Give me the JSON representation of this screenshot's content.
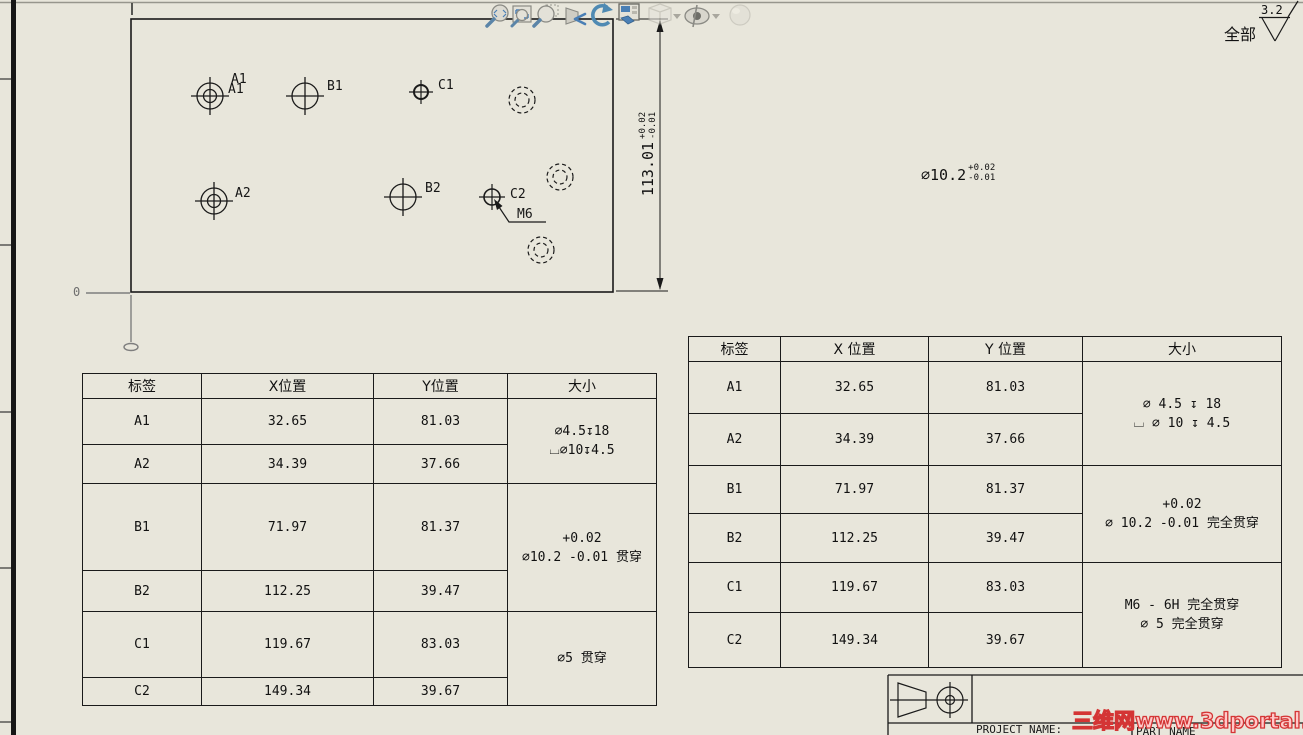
{
  "toolbar": {
    "icons": [
      "zoom-to-fit-icon",
      "zoom-to-area-icon",
      "zoom-icon",
      "previous-view-icon",
      "rotate-view-icon",
      "view-orientation-icon",
      "display-style-icon",
      "hide-show-items-icon",
      "edit-appearance-icon"
    ]
  },
  "drawing": {
    "origin_label": "0",
    "thread_callout": "M6",
    "hole_labels": {
      "a1": "A1",
      "b1": "B1",
      "c1": "C1",
      "a2": "A2",
      "b2": "B2",
      "c2": "C2"
    },
    "height_dim": {
      "value": "113.01",
      "tol_plus": "+0.02",
      "tol_minus": "-0.01"
    },
    "dia_note": {
      "value": "∅10.2",
      "tol_plus": "+0.02",
      "tol_minus": "-0.01"
    },
    "surface_finish": {
      "scope": "全部",
      "value": "3.2"
    }
  },
  "hole_table_left": {
    "headers": [
      "标签",
      "X位置",
      "Y位置",
      "大小"
    ],
    "rows": [
      {
        "label": "A1",
        "x": "32.65",
        "y": "81.03"
      },
      {
        "label": "A2",
        "x": "34.39",
        "y": "37.66"
      },
      {
        "label": "B1",
        "x": "71.97",
        "y": "81.37"
      },
      {
        "label": "B2",
        "x": "112.25",
        "y": "39.47"
      },
      {
        "label": "C1",
        "x": "119.67",
        "y": "83.03"
      },
      {
        "label": "C2",
        "x": "149.34",
        "y": "39.67"
      }
    ],
    "size_groups": [
      {
        "rows": [
          0,
          1
        ],
        "lines": [
          "∅4.5↧18",
          "⌴∅10↧4.5"
        ]
      },
      {
        "rows": [
          2,
          3
        ],
        "lines": [
          "+0.02",
          "∅10.2 -0.01 贯穿"
        ]
      },
      {
        "rows": [
          4,
          5
        ],
        "lines": [
          "∅5 贯穿"
        ]
      }
    ]
  },
  "hole_table_right": {
    "headers": [
      "标签",
      "X 位置",
      "Y 位置",
      "大小"
    ],
    "rows": [
      {
        "label": "A1",
        "x": "32.65",
        "y": "81.03"
      },
      {
        "label": "A2",
        "x": "34.39",
        "y": "37.66"
      },
      {
        "label": "B1",
        "x": "71.97",
        "y": "81.37"
      },
      {
        "label": "B2",
        "x": "112.25",
        "y": "39.47"
      },
      {
        "label": "C1",
        "x": "119.67",
        "y": "83.03"
      },
      {
        "label": "C2",
        "x": "149.34",
        "y": "39.67"
      }
    ],
    "size_groups": [
      {
        "rows": [
          0,
          1
        ],
        "lines": [
          "∅ 4.5 ↧ 18",
          "⌴ ∅ 10 ↧ 4.5"
        ]
      },
      {
        "rows": [
          2,
          3
        ],
        "lines": [
          "+0.02",
          "∅ 10.2 -0.01 完全贯穿"
        ]
      },
      {
        "rows": [
          4,
          5
        ],
        "lines": [
          "M6 - 6H 完全贯穿",
          "∅ 5 完全贯穿"
        ]
      }
    ]
  },
  "title_block": {
    "project_label": "PROJECT NAME:",
    "part_label": "PART NAME"
  },
  "watermark": {
    "text": "三维网www.3dportal.cn"
  }
}
